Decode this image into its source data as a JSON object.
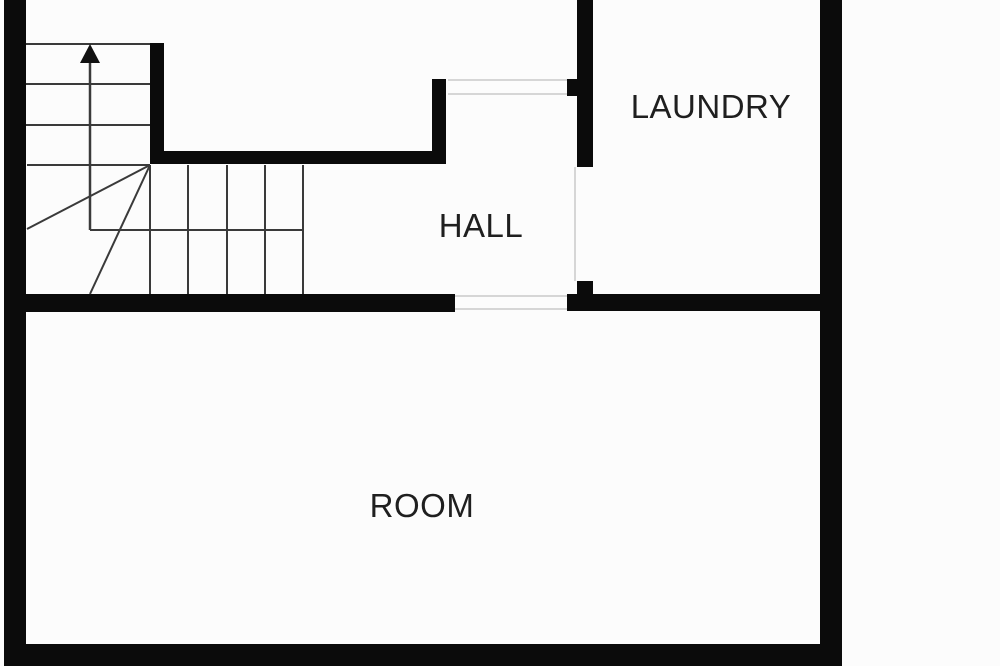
{
  "plan": {
    "type": "floor-plan",
    "rooms": {
      "laundry": {
        "label": "LAUNDRY"
      },
      "hall": {
        "label": "HALL"
      },
      "room": {
        "label": "ROOM"
      }
    },
    "stairs": {
      "direction": "up",
      "icon": "up-arrow-icon",
      "upper_flight_treads": 4,
      "lower_flight_treads": 5
    },
    "colors": {
      "background": "#fcfcfc",
      "wall": "#0b0b0b",
      "stair_line": "#3a3a3a",
      "door_threshold_line": "#d6d6d6",
      "label_text": "#1f1f1f"
    }
  }
}
